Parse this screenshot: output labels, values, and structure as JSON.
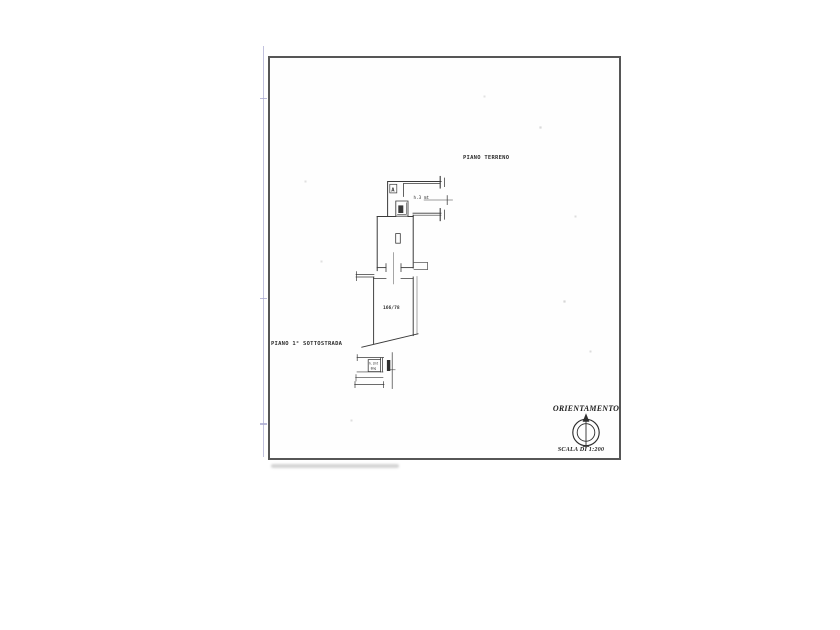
{
  "sheet": {
    "frame_color": "#565656",
    "margin_line_color": "#b6b6d8",
    "line_color": "#3a3a3a",
    "stair_fill_color": "#2f2f2f"
  },
  "labels": {
    "ground_floor": "PIANO TERRENO",
    "basement": "PIANO 1° SOTTOSTRADA",
    "orientation": "ORIENTAMENTO",
    "scale": "SCALA DI 1:200"
  },
  "annotations": {
    "room_letter": "A",
    "ground_floor_height": "h.3 mt",
    "parcel_number": "166/78",
    "basement_height": "h.2mt",
    "basement_area": "8mq"
  }
}
